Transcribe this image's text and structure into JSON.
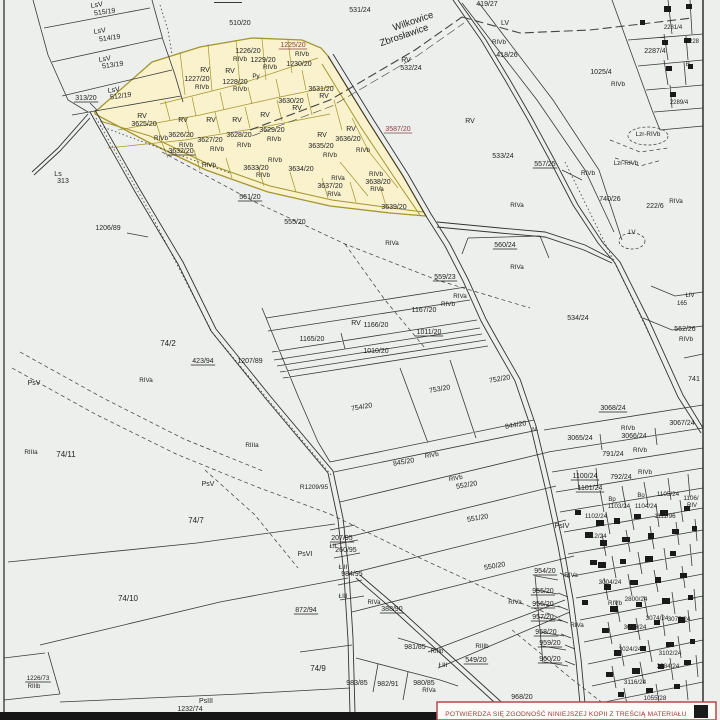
{
  "map": {
    "type": "cadastral-parcel-map",
    "boundary_names": [
      "Wilkowice",
      "Zbrosławice"
    ],
    "stamp": {
      "text": "POTWIERDZA SIĘ ZGODNOŚĆ NINIEJSZEJ KOPII Z TREŚCIĄ MATERIAŁU"
    },
    "colors": {
      "paper": "#edefec",
      "line": "#3a3a3a",
      "label": "#222222",
      "label_red": "#8a4040",
      "highlight_fill": "#f9f2cc",
      "highlight_stroke": "#a3952f",
      "stamp_red": "#a03a3c"
    },
    "labels": [
      {
        "t": "LsV",
        "x": 97,
        "y": 7,
        "r": -8
      },
      {
        "t": "515/19",
        "x": 105,
        "y": 14,
        "r": -8
      },
      {
        "t": "LsV",
        "x": 100,
        "y": 33,
        "r": -8
      },
      {
        "t": "514/19",
        "x": 110,
        "y": 40,
        "r": -8
      },
      {
        "t": "LsV",
        "x": 105,
        "y": 61,
        "r": -8
      },
      {
        "t": "513/19",
        "x": 113,
        "y": 67,
        "r": -8
      },
      {
        "t": "LsV",
        "x": 114,
        "y": 92,
        "r": -8
      },
      {
        "t": "512/19",
        "x": 121,
        "y": 98,
        "r": -8
      },
      {
        "t": "313/20",
        "x": 86,
        "y": 100,
        "u": true
      },
      {
        "t": "Ls",
        "x": 58,
        "y": 176
      },
      {
        "t": "313",
        "x": 63,
        "y": 183
      },
      {
        "t": "1206/89",
        "x": 108,
        "y": 230
      },
      {
        "t": "510/20",
        "x": 240,
        "y": 25
      },
      {
        "t": "531/24",
        "x": 360,
        "y": 12
      },
      {
        "t": "Wilkowice",
        "x": 414,
        "y": 24,
        "s": 9.5,
        "r": -19
      },
      {
        "t": "Zbrosławice",
        "x": 405,
        "y": 38,
        "s": 9.5,
        "r": -19
      },
      {
        "t": "419/27",
        "x": 487,
        "y": 6
      },
      {
        "t": "RV",
        "x": 406,
        "y": 62
      },
      {
        "t": "532/24",
        "x": 411,
        "y": 70
      },
      {
        "t": "LV",
        "x": 505,
        "y": 25
      },
      {
        "t": "RIVb",
        "x": 499,
        "y": 44,
        "s": 6.3
      },
      {
        "t": "418/26",
        "x": 507,
        "y": 57
      },
      {
        "t": "1025/4",
        "x": 601,
        "y": 74
      },
      {
        "t": "RIVb",
        "x": 618,
        "y": 86,
        "s": 6.3
      },
      {
        "t": "2287/4",
        "x": 655,
        "y": 53
      },
      {
        "t": "B",
        "x": 688,
        "y": 66,
        "s": 6.3
      },
      {
        "t": "2281/4",
        "x": 673,
        "y": 29,
        "s": 6
      },
      {
        "t": "228",
        "x": 694,
        "y": 43,
        "s": 6
      },
      {
        "t": "2289/4",
        "x": 679,
        "y": 104,
        "s": 6
      },
      {
        "t": "Lzr-RIVb",
        "x": 648,
        "y": 136,
        "s": 6.3
      },
      {
        "t": "1225/20",
        "x": 293,
        "y": 47,
        "u": true,
        "red": true
      },
      {
        "t": "RIVb",
        "x": 302,
        "y": 56,
        "s": 6.3
      },
      {
        "t": "1230/20",
        "x": 299,
        "y": 66
      },
      {
        "t": "1226/20",
        "x": 248,
        "y": 53
      },
      {
        "t": "RIVb",
        "x": 240,
        "y": 61,
        "s": 6.3
      },
      {
        "t": "1229/20",
        "x": 263,
        "y": 62
      },
      {
        "t": "RIVb",
        "x": 270,
        "y": 69,
        "s": 6.3
      },
      {
        "t": "RV",
        "x": 205,
        "y": 72
      },
      {
        "t": "1227/20",
        "x": 197,
        "y": 81
      },
      {
        "t": "RIVb",
        "x": 202,
        "y": 89,
        "s": 6.3
      },
      {
        "t": "RV",
        "x": 230,
        "y": 73
      },
      {
        "t": "1228/20",
        "x": 235,
        "y": 84
      },
      {
        "t": "RIVb",
        "x": 240,
        "y": 91,
        "s": 6.3
      },
      {
        "t": "Py",
        "x": 256,
        "y": 78,
        "s": 6.3
      },
      {
        "t": "3631/20",
        "x": 321,
        "y": 91
      },
      {
        "t": "RV",
        "x": 324,
        "y": 98
      },
      {
        "t": "3630/20",
        "x": 291,
        "y": 103
      },
      {
        "t": "RV",
        "x": 297,
        "y": 110
      },
      {
        "t": "RV",
        "x": 142,
        "y": 118
      },
      {
        "t": "3625/20",
        "x": 144,
        "y": 126
      },
      {
        "t": "RV",
        "x": 183,
        "y": 122
      },
      {
        "t": "RIVb",
        "x": 161,
        "y": 140,
        "s": 6.3
      },
      {
        "t": "3626/20",
        "x": 181,
        "y": 137
      },
      {
        "t": "RIVb",
        "x": 186,
        "y": 147,
        "s": 6.3
      },
      {
        "t": "RV",
        "x": 211,
        "y": 122
      },
      {
        "t": "3627/20",
        "x": 210,
        "y": 142
      },
      {
        "t": "RIVb",
        "x": 217,
        "y": 151,
        "s": 6.3
      },
      {
        "t": "RV",
        "x": 237,
        "y": 122
      },
      {
        "t": "3628/20",
        "x": 239,
        "y": 137
      },
      {
        "t": "RIVb",
        "x": 244,
        "y": 147,
        "s": 6.3
      },
      {
        "t": "RV",
        "x": 265,
        "y": 117
      },
      {
        "t": "3629/20",
        "x": 272,
        "y": 132
      },
      {
        "t": "RIVb",
        "x": 274,
        "y": 141,
        "s": 6.3
      },
      {
        "t": "RV",
        "x": 322,
        "y": 137
      },
      {
        "t": "3636/20",
        "x": 348,
        "y": 141
      },
      {
        "t": "RIVb",
        "x": 363,
        "y": 152,
        "s": 6.3
      },
      {
        "t": "RV",
        "x": 351,
        "y": 131
      },
      {
        "t": "3635/20",
        "x": 321,
        "y": 148
      },
      {
        "t": "RIVb",
        "x": 330,
        "y": 157,
        "s": 6.3
      },
      {
        "t": "3632/20",
        "x": 181,
        "y": 153,
        "u": true
      },
      {
        "t": "RIVb",
        "x": 209,
        "y": 167,
        "s": 6.3
      },
      {
        "t": "RIVb",
        "x": 275,
        "y": 162,
        "s": 6.3
      },
      {
        "t": "3633/20",
        "x": 256,
        "y": 170
      },
      {
        "t": "RIVb",
        "x": 263,
        "y": 177,
        "s": 6.3
      },
      {
        "t": "3634/20",
        "x": 301,
        "y": 171
      },
      {
        "t": "RIVa",
        "x": 338,
        "y": 180,
        "s": 6.3
      },
      {
        "t": "3637/20",
        "x": 330,
        "y": 188
      },
      {
        "t": "RIVa",
        "x": 334,
        "y": 196,
        "s": 6.3
      },
      {
        "t": "RIVb",
        "x": 376,
        "y": 176,
        "s": 6.3
      },
      {
        "t": "3638/20",
        "x": 378,
        "y": 184
      },
      {
        "t": "RIVa",
        "x": 377,
        "y": 191,
        "s": 6.3
      },
      {
        "t": "3639/20",
        "x": 394,
        "y": 209
      },
      {
        "t": "3587/20",
        "x": 398,
        "y": 131,
        "u": true,
        "red": true
      },
      {
        "t": "561/20",
        "x": 250,
        "y": 199,
        "u": true
      },
      {
        "t": "RV",
        "x": 470,
        "y": 123
      },
      {
        "t": "533/24",
        "x": 503,
        "y": 158
      },
      {
        "t": "557/25",
        "x": 545,
        "y": 166,
        "u": true
      },
      {
        "t": "RIVb",
        "x": 588,
        "y": 175,
        "s": 6.3
      },
      {
        "t": "Lzr-RIVb",
        "x": 626,
        "y": 165,
        "s": 6.3
      },
      {
        "t": "740/26",
        "x": 610,
        "y": 201
      },
      {
        "t": "222/6",
        "x": 655,
        "y": 208
      },
      {
        "t": "RIVa",
        "x": 676,
        "y": 203,
        "s": 6.3
      },
      {
        "t": "LV",
        "x": 632,
        "y": 234,
        "s": 6.3
      },
      {
        "t": "555/20",
        "x": 295,
        "y": 224
      },
      {
        "t": "RIVa",
        "x": 392,
        "y": 245,
        "s": 6.3
      },
      {
        "t": "RIVa",
        "x": 517,
        "y": 207,
        "s": 6.3
      },
      {
        "t": "560/24",
        "x": 505,
        "y": 247,
        "u": true
      },
      {
        "t": "RIVa",
        "x": 517,
        "y": 269,
        "s": 6.3
      },
      {
        "t": "559/23",
        "x": 445,
        "y": 279,
        "u": true
      },
      {
        "t": "RIVa",
        "x": 460,
        "y": 298,
        "s": 6.3
      },
      {
        "t": "1167/20",
        "x": 424,
        "y": 312
      },
      {
        "t": "RIVb",
        "x": 448,
        "y": 306,
        "s": 6.3
      },
      {
        "t": "RV",
        "x": 356,
        "y": 325
      },
      {
        "t": "1166/20",
        "x": 376,
        "y": 327
      },
      {
        "t": "1011/20",
        "x": 429,
        "y": 334,
        "u": true
      },
      {
        "t": "1165/20",
        "x": 312,
        "y": 341
      },
      {
        "t": "1010/20",
        "x": 376,
        "y": 353
      },
      {
        "t": "534/24",
        "x": 578,
        "y": 320
      },
      {
        "t": "ŁIV",
        "x": 690,
        "y": 297,
        "s": 6
      },
      {
        "t": "165",
        "x": 682,
        "y": 305,
        "s": 6
      },
      {
        "t": "562/26",
        "x": 685,
        "y": 331
      },
      {
        "t": "RIVb",
        "x": 686,
        "y": 341,
        "s": 6.3
      },
      {
        "t": "741",
        "x": 694,
        "y": 381
      },
      {
        "t": "74/2",
        "x": 168,
        "y": 346,
        "s": 8
      },
      {
        "t": "423/94",
        "x": 203,
        "y": 363,
        "u": true
      },
      {
        "t": "1207/89",
        "x": 250,
        "y": 363
      },
      {
        "t": "RIVa",
        "x": 146,
        "y": 382,
        "s": 6.3
      },
      {
        "t": "PsV",
        "x": 34,
        "y": 385
      },
      {
        "t": "RIIIa",
        "x": 31,
        "y": 454,
        "s": 6.3
      },
      {
        "t": "74/11",
        "x": 66,
        "y": 457,
        "s": 8
      },
      {
        "t": "RIIIa",
        "x": 252,
        "y": 447,
        "s": 6.3
      },
      {
        "t": "PsV",
        "x": 208,
        "y": 486
      },
      {
        "t": "74/7",
        "x": 196,
        "y": 523,
        "s": 8
      },
      {
        "t": "752/20",
        "x": 500,
        "y": 381,
        "r": -10
      },
      {
        "t": "753/20",
        "x": 440,
        "y": 391,
        "r": -10
      },
      {
        "t": "754/20",
        "x": 362,
        "y": 409,
        "r": -10
      },
      {
        "t": "844/20",
        "x": 516,
        "y": 427,
        "r": -10
      },
      {
        "t": "N",
        "x": 534,
        "y": 431,
        "s": 5
      },
      {
        "t": "845/20",
        "x": 404,
        "y": 464,
        "r": -10
      },
      {
        "t": "RIVb",
        "x": 432,
        "y": 457,
        "s": 6.3,
        "r": -10
      },
      {
        "t": "RIVb",
        "x": 456,
        "y": 480,
        "s": 6.3,
        "r": -10
      },
      {
        "t": "552/20",
        "x": 467,
        "y": 487,
        "r": -10
      },
      {
        "t": "551/20",
        "x": 478,
        "y": 520,
        "r": -10
      },
      {
        "t": "550/20",
        "x": 495,
        "y": 568,
        "r": -10
      },
      {
        "t": "PsIV",
        "x": 562,
        "y": 528
      },
      {
        "t": "R1209/95",
        "x": 314,
        "y": 489,
        "s": 6.5
      },
      {
        "t": "3068/24",
        "x": 613,
        "y": 410,
        "u": true
      },
      {
        "t": "3065/24",
        "x": 580,
        "y": 440
      },
      {
        "t": "RIVb",
        "x": 628,
        "y": 430,
        "s": 6.3
      },
      {
        "t": "3066/24",
        "x": 634,
        "y": 438
      },
      {
        "t": "3067/24",
        "x": 682,
        "y": 425
      },
      {
        "t": "791/24",
        "x": 613,
        "y": 456
      },
      {
        "t": "RIVb",
        "x": 640,
        "y": 452,
        "s": 6.3
      },
      {
        "t": "1100/24",
        "x": 585,
        "y": 478,
        "u": true
      },
      {
        "t": "792/24",
        "x": 621,
        "y": 479
      },
      {
        "t": "RIVb",
        "x": 645,
        "y": 474,
        "s": 6.3
      },
      {
        "t": "1101/24",
        "x": 590,
        "y": 490,
        "u": true
      },
      {
        "t": "Bp",
        "x": 612,
        "y": 501,
        "s": 6
      },
      {
        "t": "Bo",
        "x": 641,
        "y": 497,
        "s": 6
      },
      {
        "t": "1103/24",
        "x": 619,
        "y": 508,
        "s": 6.3
      },
      {
        "t": "1104/24",
        "x": 646,
        "y": 508,
        "s": 6.3
      },
      {
        "t": "1105/24",
        "x": 668,
        "y": 496,
        "s": 6.3
      },
      {
        "t": "1106/",
        "x": 691,
        "y": 500,
        "s": 6.3
      },
      {
        "t": "RIV",
        "x": 692,
        "y": 507,
        "s": 6
      },
      {
        "t": "1102/24",
        "x": 596,
        "y": 518,
        "s": 6.3
      },
      {
        "t": "1111/96",
        "x": 665,
        "y": 518,
        "s": 6.3
      },
      {
        "t": "912/24",
        "x": 597,
        "y": 538,
        "s": 6.3
      },
      {
        "t": "954/20",
        "x": 545,
        "y": 573,
        "u": true
      },
      {
        "t": "RIVa",
        "x": 571,
        "y": 577,
        "s": 6.3
      },
      {
        "t": "955/20",
        "x": 543,
        "y": 593,
        "u": true
      },
      {
        "t": "956/20",
        "x": 543,
        "y": 606,
        "u": true
      },
      {
        "t": "957/20",
        "x": 543,
        "y": 619,
        "u": true
      },
      {
        "t": "RIVa",
        "x": 515,
        "y": 604,
        "s": 6.3
      },
      {
        "t": "958/20",
        "x": 546,
        "y": 634,
        "u": true
      },
      {
        "t": "959/20",
        "x": 550,
        "y": 645,
        "u": true
      },
      {
        "t": "960/20",
        "x": 550,
        "y": 661,
        "u": true
      },
      {
        "t": "RIVa",
        "x": 577,
        "y": 627,
        "s": 6.3
      },
      {
        "t": "PsVI",
        "x": 305,
        "y": 556
      },
      {
        "t": "207/95",
        "x": 342,
        "y": 540,
        "u": true
      },
      {
        "t": "ŁII",
        "x": 333,
        "y": 548,
        "s": 6.3
      },
      {
        "t": "260/95",
        "x": 346,
        "y": 552
      },
      {
        "t": "ŁIII",
        "x": 343,
        "y": 569,
        "s": 6.3
      },
      {
        "t": "984/95",
        "x": 352,
        "y": 576
      },
      {
        "t": "ŁIII",
        "x": 343,
        "y": 598,
        "s": 6.3
      },
      {
        "t": "872/94",
        "x": 306,
        "y": 612,
        "u": true
      },
      {
        "t": "388/90",
        "x": 392,
        "y": 611,
        "u": true
      },
      {
        "t": "RIVa",
        "x": 374,
        "y": 604,
        "s": 6
      },
      {
        "t": "74/10",
        "x": 128,
        "y": 601,
        "s": 8
      },
      {
        "t": "74/9",
        "x": 318,
        "y": 671,
        "s": 8
      },
      {
        "t": "1226/73",
        "x": 38,
        "y": 680,
        "s": 6.3,
        "u": true
      },
      {
        "t": "RIIIb",
        "x": 34,
        "y": 688,
        "s": 6
      },
      {
        "t": "PsIII",
        "x": 206,
        "y": 703
      },
      {
        "t": "1232/74",
        "x": 190,
        "y": 711
      },
      {
        "t": "983/85",
        "x": 357,
        "y": 685
      },
      {
        "t": "982/91",
        "x": 388,
        "y": 686
      },
      {
        "t": "981/85",
        "x": 415,
        "y": 649
      },
      {
        "t": "RIIIb",
        "x": 437,
        "y": 653,
        "s": 6
      },
      {
        "t": "ŁIII",
        "x": 443,
        "y": 667,
        "s": 6.3
      },
      {
        "t": "549/20",
        "x": 476,
        "y": 662,
        "u": true
      },
      {
        "t": "RIIIb",
        "x": 482,
        "y": 648,
        "s": 6.3
      },
      {
        "t": "980/85",
        "x": 424,
        "y": 685
      },
      {
        "t": "RIVa",
        "x": 429,
        "y": 692,
        "s": 6.3
      },
      {
        "t": "968/20",
        "x": 522,
        "y": 699
      },
      {
        "t": "RIVb",
        "x": 615,
        "y": 605,
        "s": 6.3
      },
      {
        "t": "3004/24",
        "x": 610,
        "y": 584,
        "s": 6.3
      },
      {
        "t": "2800/24",
        "x": 636,
        "y": 601,
        "s": 6.3
      },
      {
        "t": "3074/24",
        "x": 657,
        "y": 620,
        "s": 6.3
      },
      {
        "t": "3075/24",
        "x": 679,
        "y": 621,
        "s": 6.3
      },
      {
        "t": "3073/24",
        "x": 635,
        "y": 629,
        "s": 6.3
      },
      {
        "t": "3024/24",
        "x": 630,
        "y": 651,
        "s": 6.3
      },
      {
        "t": "3102/24",
        "x": 670,
        "y": 655,
        "s": 6.3
      },
      {
        "t": "3084/24",
        "x": 668,
        "y": 668,
        "s": 6.3
      },
      {
        "t": "3116/24",
        "x": 635,
        "y": 684,
        "s": 6.3
      },
      {
        "t": "1055/28",
        "x": 655,
        "y": 700,
        "s": 6.3
      }
    ]
  }
}
